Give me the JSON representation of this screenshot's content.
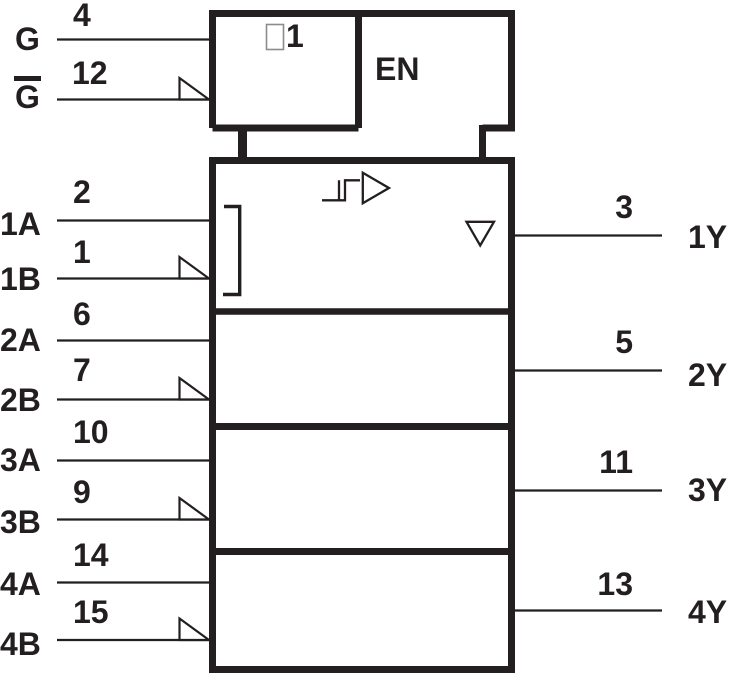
{
  "colors": {
    "ink": "#231f20",
    "qualifier_box_outline": "#8c8c8c",
    "background": "#ffffff"
  },
  "enable_block": {
    "qualifier_symbol": "1",
    "en_label": "EN",
    "g": {
      "label": "G",
      "pin": "4"
    },
    "gbar": {
      "label": "G",
      "pin": "12",
      "overline": true,
      "polarity_indicator": true
    }
  },
  "channels": [
    {
      "a": {
        "label": "1A",
        "pin": "2"
      },
      "b": {
        "label": "1B",
        "pin": "1",
        "polarity_indicator": true
      },
      "y": {
        "label": "1Y",
        "pin": "3"
      }
    },
    {
      "a": {
        "label": "2A",
        "pin": "6"
      },
      "b": {
        "label": "2B",
        "pin": "7",
        "polarity_indicator": true
      },
      "y": {
        "label": "2Y",
        "pin": "5"
      }
    },
    {
      "a": {
        "label": "3A",
        "pin": "10"
      },
      "b": {
        "label": "3B",
        "pin": "9",
        "polarity_indicator": true
      },
      "y": {
        "label": "3Y",
        "pin": "11"
      }
    },
    {
      "a": {
        "label": "4A",
        "pin": "14"
      },
      "b": {
        "label": "4B",
        "pin": "15",
        "polarity_indicator": true
      },
      "y": {
        "label": "4Y",
        "pin": "13"
      }
    }
  ],
  "symbols": {
    "section1": [
      "hysteresis",
      "amplifier",
      "three-state-output"
    ],
    "grouping": "differential-input-bracket"
  }
}
